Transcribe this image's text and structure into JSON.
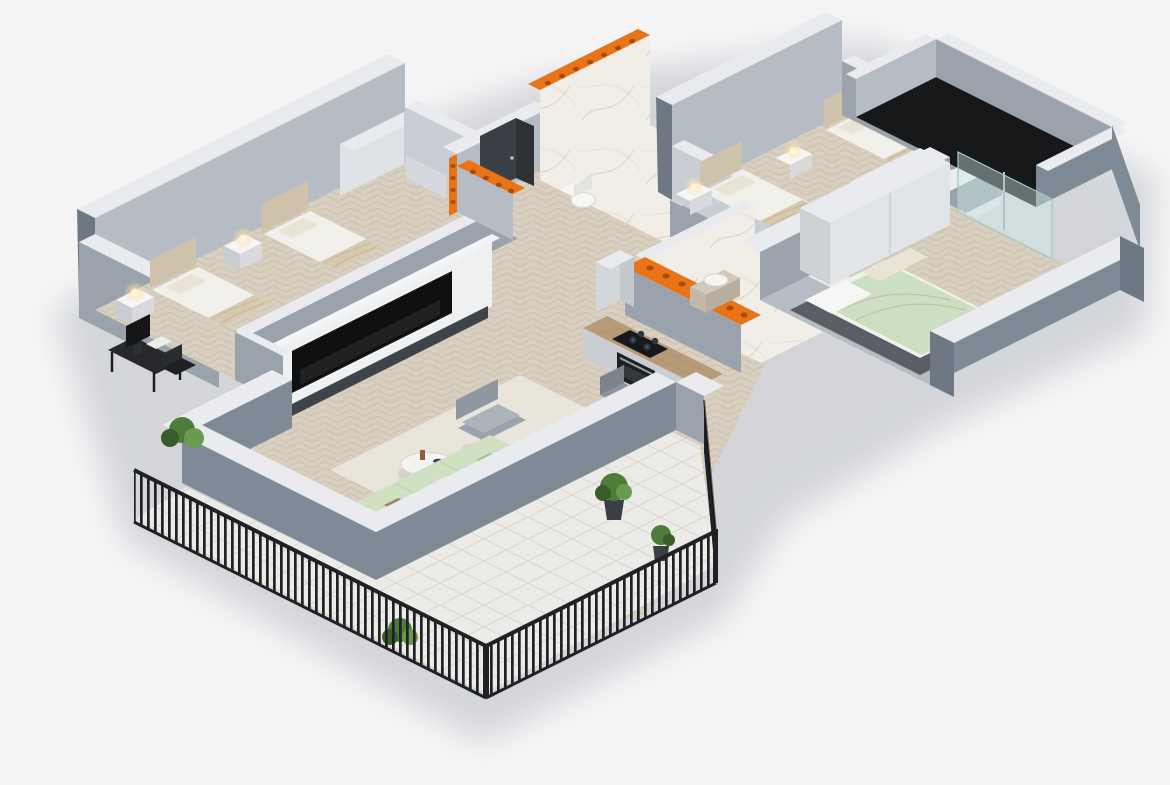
{
  "scene": {
    "kind": "isometric-3d-apartment-floor-plan-render",
    "rooms": [
      {
        "id": "bedroom-left",
        "furniture": [
          "twin bed",
          "twin bed",
          "nightstand with lamp",
          "nightstand with lamp",
          "desk with monitor and chair",
          "corner wardrobe"
        ]
      },
      {
        "id": "entrance-hall",
        "furniture": [
          "entry door ajar"
        ]
      },
      {
        "id": "bathroom-main",
        "furniture": [
          "walk-in shower with glass panel",
          "toilet",
          "washing machine"
        ]
      },
      {
        "id": "bedroom-top-right",
        "furniture": [
          "twin bed",
          "twin bed",
          "nightstand with glowing lamp",
          "nightstand with glowing lamp",
          "sliding wardrobe"
        ]
      },
      {
        "id": "balcony-right",
        "furniture": [
          "dark floor deck"
        ]
      },
      {
        "id": "bedroom-right",
        "furniture": [
          "double bed with green blanket",
          "wardrobe",
          "dark rug",
          "sliding glass door"
        ]
      },
      {
        "id": "shower-room",
        "furniture": [
          "vanity with basin",
          "walk-in shower with glass panel"
        ]
      },
      {
        "id": "kitchen",
        "furniture": [
          "counter with cooktop",
          "built-in oven",
          "tall cabinet"
        ]
      },
      {
        "id": "dining-area",
        "furniture": [
          "wooden dining table",
          "chair",
          "chair",
          "chair",
          "chair",
          "decorative plate"
        ]
      },
      {
        "id": "living-room",
        "furniture": [
          "media wall with TV",
          "corner sofa with pillows",
          "round coffee table",
          "side table",
          "armchair",
          "cream rug"
        ]
      },
      {
        "id": "terrace",
        "furniture": [
          "white tile floor",
          "black slat railing",
          "green bushes"
        ]
      },
      {
        "id": "south-balcony",
        "furniture": [
          "potted plant",
          "potted plant",
          "black slat railing"
        ]
      }
    ],
    "accents": {
      "wall_cut_blocks": "orange hollow clay-block cross sections on cut wall tops and ends"
    }
  },
  "palette": {
    "bg": "#f5f5f6",
    "shadow": "#c3c6cc",
    "wallOuter": "#7f8a97",
    "wallOuterDark": "#6e7885",
    "wallMid": "#9aa2ac",
    "wallInner": "#b6bcc4",
    "wallLight": "#c9ced5",
    "wallTop": "#e9ebee",
    "wallWhite": "#eef0f2",
    "floorWood": "#d9cfc0",
    "woodLine": "#c8bca8",
    "floorTile": "#ecebe7",
    "tileLine": "#d9d7d1",
    "floorMarble": "#f1eee7",
    "marbleVein": "#d5c9b2",
    "balconyDark": "#17181a",
    "railing": "#1f2125",
    "orange": "#e87417",
    "orangeDot": "#a84a05",
    "bedWhite": "#f2f0ea",
    "bedBeige": "#d6c9ae",
    "headboard": "#cfc2ab",
    "pillow": "#e9e3d5",
    "sofa": "#cfe0c3",
    "sofaDark": "#c0d2b4",
    "rug": "#e9e5db",
    "rugDark": "#4b4e54",
    "wood": "#b79b79",
    "woodDark": "#8a7458",
    "tv": "#0e0f11",
    "cabinetDark": "#3f444a",
    "chair": "#8d949c",
    "chairDark": "#7b838c",
    "armchair": "#9aa2ab",
    "plantGreen": "#4e7d3a",
    "plantDark": "#3a5c2b",
    "plantLight": "#699a4f",
    "glass": "#cfeeea",
    "glassEdge": "#9fc9c4",
    "chrome": "#c3c9cf",
    "applianceDark": "#1d2023",
    "vanity": "#cfc8bd",
    "lamp": "#ffd9a0"
  }
}
